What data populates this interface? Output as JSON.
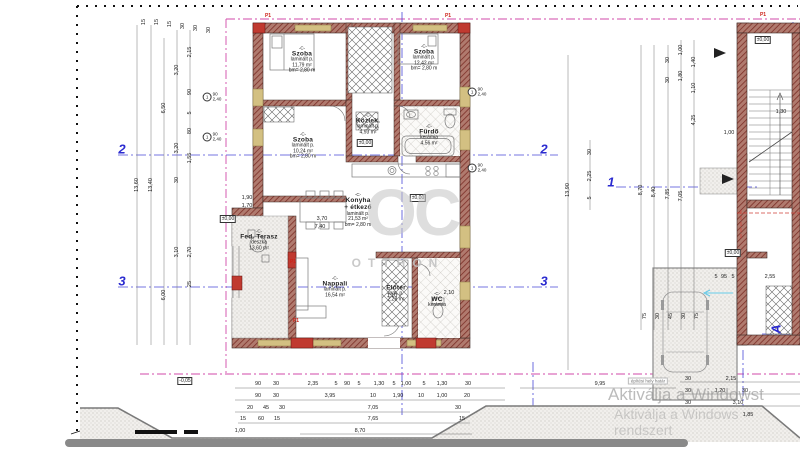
{
  "title": "Floor plan drawing (ground floor) with dimensions",
  "colors": {
    "wall": "#b07a6e",
    "wall_hatch": "#7c2f27",
    "accent_red": "#cc2218",
    "section_blue": "#2b2bd0",
    "boundary_magenta": "#d24aaa",
    "watermark_gray": "#c4c4c4"
  },
  "brand_watermark": {
    "top": "OC",
    "bottom": "OTTHON"
  },
  "windows_watermark": {
    "line1": "Aktiválja a Windowst",
    "line2": "Aktiválja a Windows rendszert"
  },
  "site_note": "építési hely határ",
  "p1_text": "P1",
  "rooms": [
    {
      "code": "-C-",
      "name": "Szoba",
      "floor": "laminált p.",
      "area": "11,79 m²",
      "height": "bm= 2,80 m",
      "x": 302,
      "y": 60
    },
    {
      "code": "-C-",
      "name": "Szoba",
      "floor": "laminált p.",
      "area": "12,42 m²",
      "height": "bm= 2,80 m",
      "x": 424,
      "y": 58
    },
    {
      "code": "-C-",
      "name": "Szoba",
      "floor": "laminált p.",
      "area": "10,24 m²",
      "height": "bm= 2,80 m",
      "x": 303,
      "y": 146
    },
    {
      "code": "-C-",
      "name": "Közlek.",
      "floor": "laminált p.",
      "area": "4,93 m²",
      "height": "",
      "x": 368,
      "y": 124
    },
    {
      "code": "-C-",
      "name": "Fürdő",
      "floor": "kerámia",
      "area": "4,56 m²",
      "height": "",
      "x": 429,
      "y": 135
    },
    {
      "code": "-C-",
      "name": "Konyha",
      "name2": "+ étkező",
      "floor": "laminált p.",
      "area": "21,53 m²",
      "height": "bm= 2,80 m",
      "x": 358,
      "y": 210
    },
    {
      "code": "-C-",
      "name": "Fed. Terasz",
      "floor": "deszka",
      "area": "13,60 m²",
      "height": "",
      "x": 259,
      "y": 240
    },
    {
      "code": "-C-",
      "name": "Nappali",
      "floor": "laminált p.",
      "area": "16,54 m²",
      "height": "",
      "x": 335,
      "y": 287
    },
    {
      "code": "-C-",
      "name": "Előtér",
      "floor": "lam. p.",
      "area": "2,28 m²",
      "height": "",
      "x": 396,
      "y": 291
    },
    {
      "code": "-C-",
      "name": "WC",
      "floor": "kerámia",
      "area": "",
      "height": "",
      "x": 437,
      "y": 300
    }
  ],
  "levels": [
    {
      "x": 365,
      "y": 143,
      "t": "±0,00"
    },
    {
      "x": 418,
      "y": 198,
      "t": "±0,00"
    },
    {
      "x": 228,
      "y": 219,
      "t": "±0,00"
    },
    {
      "x": 733,
      "y": 253,
      "t": "±0,00"
    },
    {
      "x": 763,
      "y": 40,
      "t": "±0,00"
    },
    {
      "x": 185,
      "y": 381,
      "t": "-0,05"
    }
  ],
  "section_markers": [
    {
      "x": 122,
      "y": 149,
      "t": "2"
    },
    {
      "x": 544,
      "y": 149,
      "t": "2"
    },
    {
      "x": 122,
      "y": 281,
      "t": "3"
    },
    {
      "x": 544,
      "y": 281,
      "t": "3"
    },
    {
      "x": 611,
      "y": 182,
      "t": "1"
    },
    {
      "x": 776,
      "y": 329,
      "t": "A",
      "r": 1
    }
  ],
  "p1_positions": [
    {
      "x": 268,
      "y": 16
    },
    {
      "x": 448,
      "y": 16
    },
    {
      "x": 763,
      "y": 15
    },
    {
      "x": 293,
      "y": 262
    },
    {
      "x": 296,
      "y": 321
    }
  ],
  "window_tag": {
    "num": "1",
    "top": "90",
    "bottom": "2,40"
  },
  "window_tag_positions": [
    {
      "x": 212,
      "y": 97
    },
    {
      "x": 212,
      "y": 137
    },
    {
      "x": 477,
      "y": 92
    },
    {
      "x": 477,
      "y": 168
    }
  ],
  "dims": [
    [
      258,
      384,
      "90"
    ],
    [
      276,
      384,
      "30"
    ],
    [
      313,
      384,
      "2,35"
    ],
    [
      336,
      384,
      "5"
    ],
    [
      347,
      384,
      "90"
    ],
    [
      359,
      384,
      "5"
    ],
    [
      379,
      384,
      "1,30"
    ],
    [
      394,
      384,
      "5"
    ],
    [
      406,
      384,
      "1,00"
    ],
    [
      424,
      384,
      "5"
    ],
    [
      442,
      384,
      "1,30"
    ],
    [
      468,
      384,
      "30"
    ],
    [
      258,
      396,
      "90"
    ],
    [
      276,
      396,
      "30"
    ],
    [
      330,
      396,
      "3,95"
    ],
    [
      373,
      396,
      "10"
    ],
    [
      398,
      396,
      "1,90"
    ],
    [
      421,
      396,
      "10"
    ],
    [
      442,
      396,
      "1,00"
    ],
    [
      467,
      396,
      "20"
    ],
    [
      250,
      408,
      "20"
    ],
    [
      266,
      408,
      "45"
    ],
    [
      282,
      408,
      "30"
    ],
    [
      373,
      408,
      "7,05"
    ],
    [
      458,
      408,
      "30"
    ],
    [
      243,
      419,
      "15"
    ],
    [
      261,
      419,
      "60"
    ],
    [
      277,
      419,
      "15"
    ],
    [
      373,
      419,
      "7,65"
    ],
    [
      462,
      419,
      "15"
    ],
    [
      240,
      431,
      "1,00"
    ],
    [
      360,
      431,
      "8,70"
    ],
    [
      600,
      384,
      "9,95"
    ],
    [
      688,
      379,
      "30"
    ],
    [
      731,
      379,
      "2,15"
    ],
    [
      688,
      391,
      "30"
    ],
    [
      720,
      391,
      "1,20"
    ],
    [
      745,
      391,
      "30"
    ],
    [
      688,
      403,
      "30"
    ],
    [
      738,
      403,
      "3,10"
    ],
    [
      748,
      415,
      "1,85"
    ],
    [
      137,
      185,
      "13,60",
      1
    ],
    [
      151,
      185,
      "13,40",
      1
    ],
    [
      164,
      108,
      "6,50",
      1
    ],
    [
      164,
      295,
      "6,00",
      1
    ],
    [
      177,
      70,
      "3,20",
      1
    ],
    [
      177,
      148,
      "3,20",
      1
    ],
    [
      177,
      252,
      "3,10",
      1
    ],
    [
      177,
      180,
      "30",
      1
    ],
    [
      190,
      52,
      "2,15",
      1
    ],
    [
      190,
      92,
      "90",
      1
    ],
    [
      190,
      113,
      "5",
      1
    ],
    [
      190,
      131,
      "80",
      1
    ],
    [
      190,
      158,
      "1,55",
      1
    ],
    [
      190,
      252,
      "2,70",
      1
    ],
    [
      190,
      284,
      "25",
      1
    ],
    [
      144,
      22,
      "15",
      1
    ],
    [
      157,
      22,
      "15",
      1
    ],
    [
      170,
      24,
      "15",
      1
    ],
    [
      183,
      26,
      "30",
      1
    ],
    [
      196,
      28,
      "30",
      1
    ],
    [
      209,
      30,
      "30",
      1
    ],
    [
      247,
      198,
      "1,90"
    ],
    [
      247,
      206,
      "1,70"
    ],
    [
      322,
      219,
      "3,70"
    ],
    [
      320,
      227,
      "7,40"
    ],
    [
      392,
      296,
      "1,10"
    ],
    [
      449,
      293,
      "2,10"
    ],
    [
      568,
      190,
      "13,90",
      1
    ],
    [
      590,
      152,
      "30",
      1
    ],
    [
      590,
      176,
      "2,25",
      1
    ],
    [
      590,
      198,
      "5",
      1
    ],
    [
      641,
      190,
      "8,70",
      1
    ],
    [
      654,
      192,
      "8,40",
      1
    ],
    [
      668,
      194,
      "7,85",
      1
    ],
    [
      681,
      196,
      "7,05",
      1
    ],
    [
      668,
      60,
      "30",
      1
    ],
    [
      668,
      80,
      "30",
      1
    ],
    [
      681,
      50,
      "1,00",
      1
    ],
    [
      681,
      76,
      "1,80",
      1
    ],
    [
      694,
      62,
      "1,40",
      1
    ],
    [
      694,
      88,
      "1,10",
      1
    ],
    [
      694,
      120,
      "4,25",
      1
    ],
    [
      645,
      316,
      "75",
      1
    ],
    [
      658,
      316,
      "30",
      1
    ],
    [
      671,
      316,
      "45",
      1
    ],
    [
      684,
      316,
      "30",
      1
    ],
    [
      697,
      316,
      "75",
      1
    ],
    [
      729,
      133,
      "1,00"
    ],
    [
      781,
      112,
      "1,30"
    ],
    [
      716,
      277,
      "5"
    ],
    [
      724,
      277,
      "95"
    ],
    [
      733,
      277,
      "5"
    ],
    [
      770,
      277,
      "2,55"
    ]
  ]
}
